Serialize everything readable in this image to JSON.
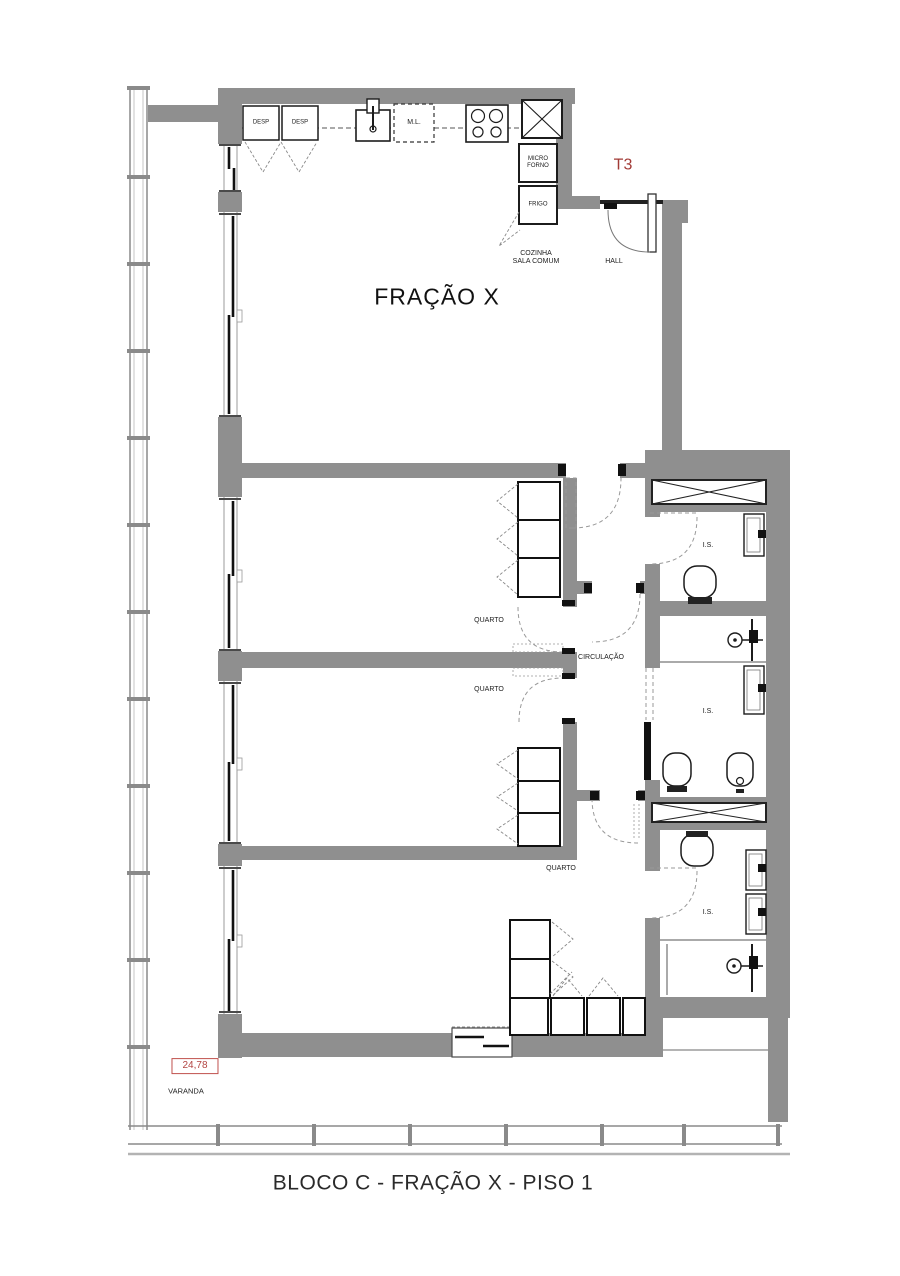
{
  "title": {
    "text": "BLOCO C - FRAÇÃO X - PISO 1"
  },
  "plan": {
    "unit_type": "T3",
    "fraction": "FRAÇÃO X",
    "balcony": {
      "area": "24,78",
      "label": "VARANDA"
    },
    "rooms": {
      "kitchen_living_line1": "COZINHA",
      "kitchen_living_line2": "SALA COMUM",
      "hall": "HALL",
      "circulation": "CIRCULAÇÃO",
      "bedroom_1": "QUARTO",
      "bedroom_2": "QUARTO",
      "bedroom_3": "QUARTO",
      "bathroom_1": "I.S.",
      "bathroom_2": "I.S.",
      "bathroom_3": "I.S."
    },
    "kitchen": {
      "pantry_1": "DESP",
      "pantry_2": "DESP",
      "dishwasher": "M.L.",
      "microwave_line1": "MICRO",
      "microwave_line2": "FORNO",
      "fridge": "FRIGO"
    },
    "colors": {
      "wall": "#8f8f8f",
      "accent_red": "#a23a36",
      "line": "#1c1c1c"
    }
  }
}
